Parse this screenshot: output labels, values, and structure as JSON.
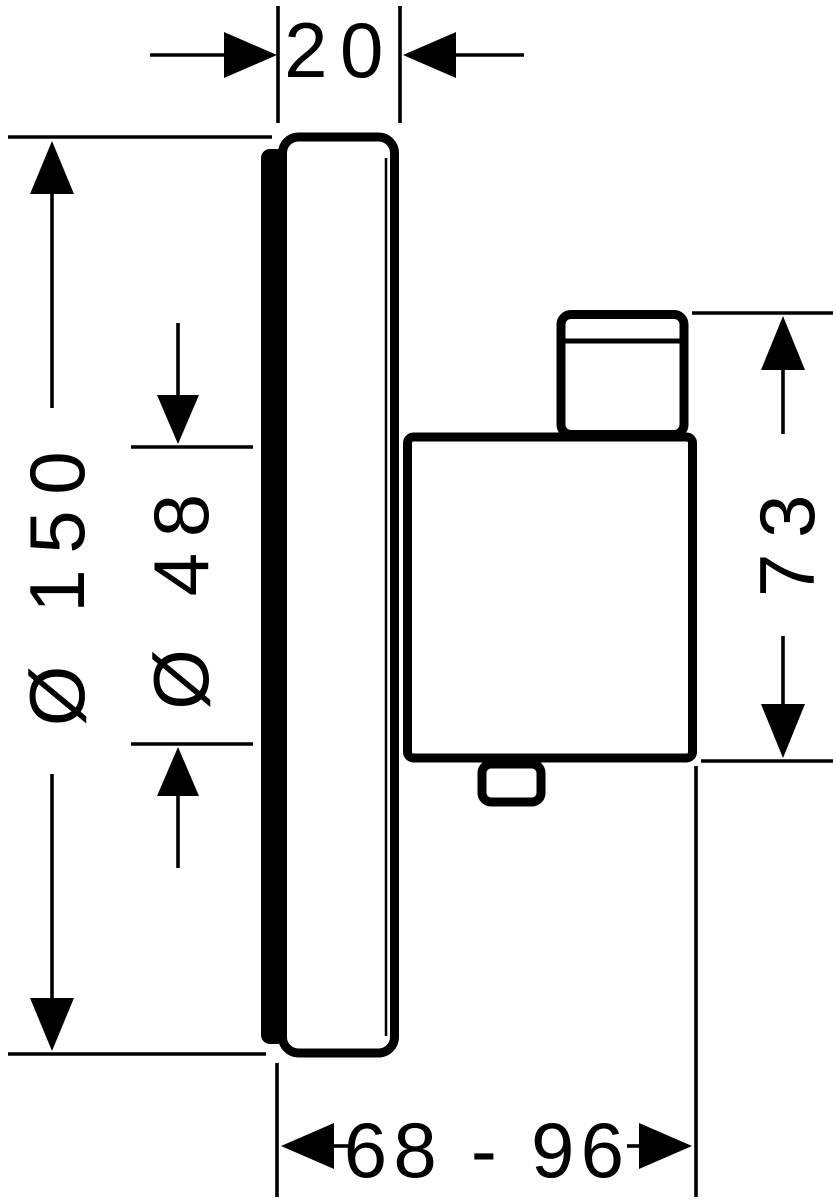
{
  "drawing": {
    "background": "#ffffff",
    "line_color": "#000000",
    "labels": {
      "plate_depth": "20",
      "plate_diameter": "Ø 150",
      "handle_diameter": "Ø 48",
      "body_height": "73",
      "installation_depth": "68 - 96"
    }
  }
}
